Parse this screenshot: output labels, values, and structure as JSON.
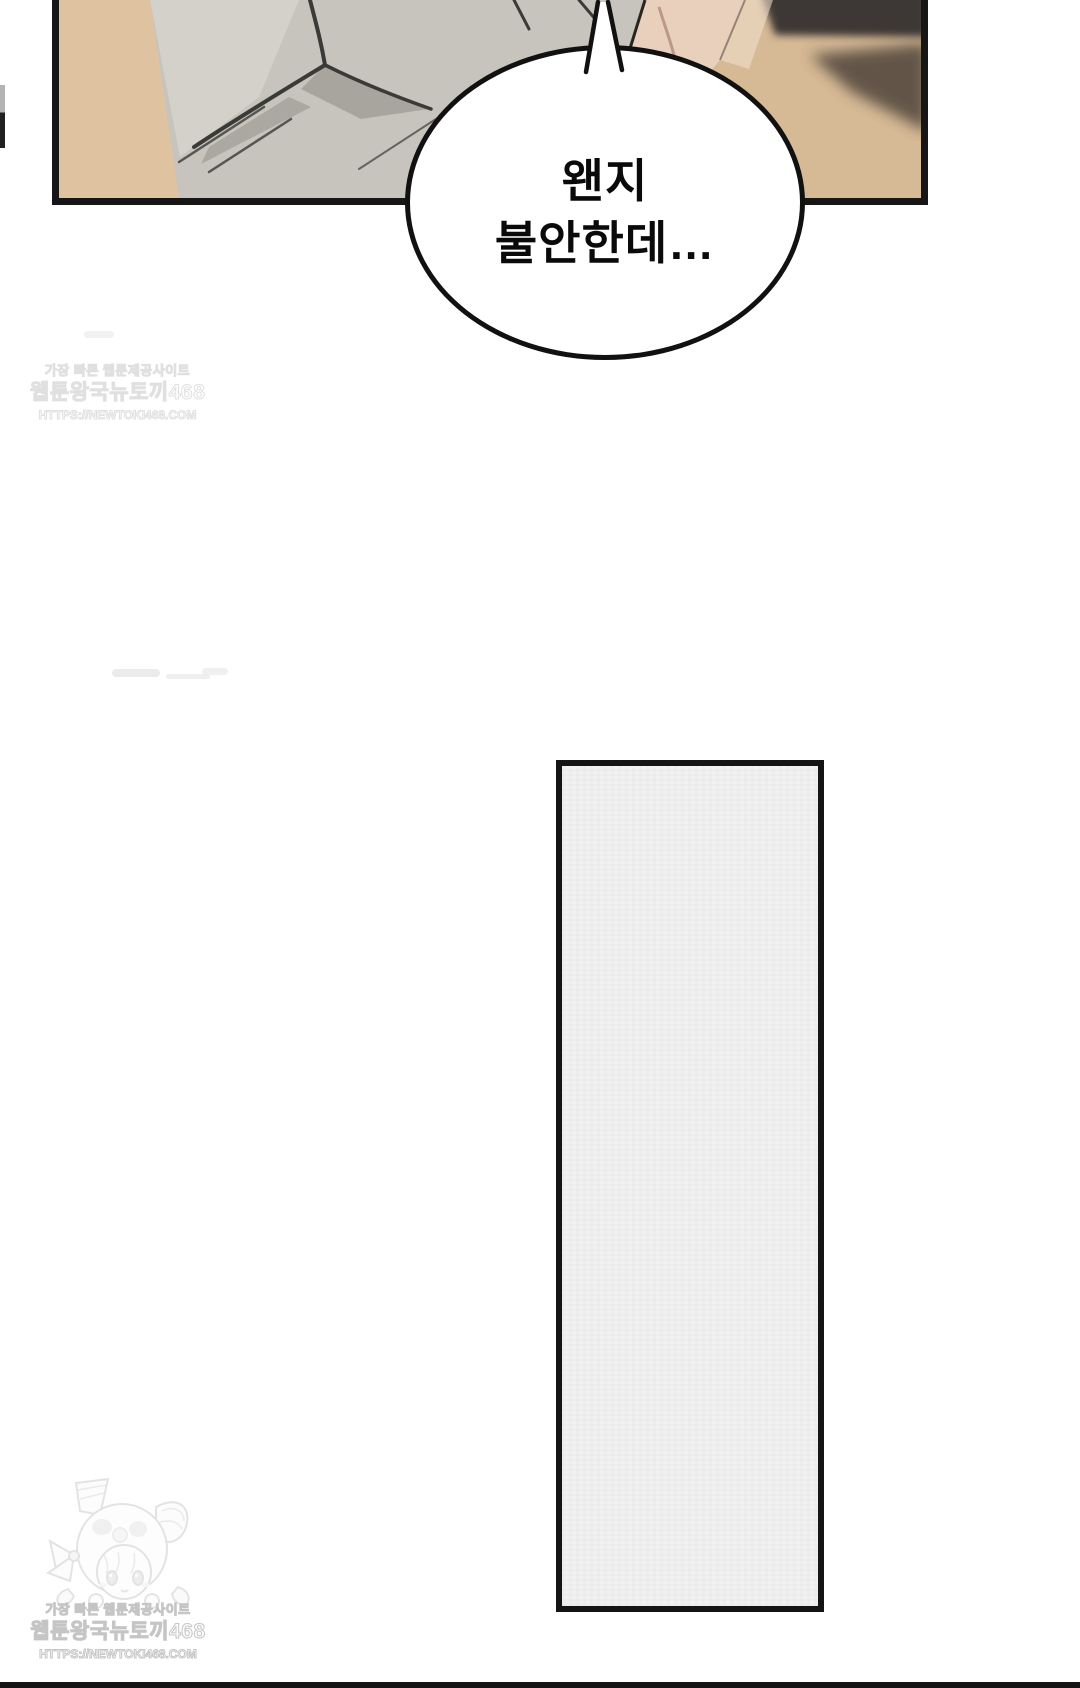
{
  "page": {
    "width": 1080,
    "height": 1688,
    "background": "#ffffff"
  },
  "comic": {
    "speech_bubble": {
      "line1": "왠지",
      "line2": "불안한데…",
      "fill": "#ffffff",
      "stroke": "#111111"
    },
    "top_panel": {
      "border_color": "#161616",
      "wall_color": "#d6b995",
      "wall_light_color": "#dfc3a0",
      "shirt_color": "#c6c4bd",
      "shirt_highlight_color": "#d9d7d0",
      "shirt_shadow_color": "#8e8c84",
      "skin_color": "#e9d0bd",
      "furniture_dark_color": "#3d3935",
      "furniture_mid_color": "#564b41"
    },
    "tall_panel": {
      "fill_color": "#f1f1f2",
      "border_color": "#141414"
    },
    "next_panel_edge_color": "#141414"
  },
  "watermarks": {
    "top": {
      "line1": "가장 빠른 웹툰제공사이트",
      "line2": "웹툰왕국뉴토끼468",
      "line3": "HTTPS://NEWTOKI468.COM"
    },
    "bottom": {
      "line1": "가장 빠른 웹툰제공사이트",
      "line2": "웹툰왕국뉴토끼468",
      "line3": "HTTPS://NEWTOKI468.COM"
    },
    "mascot_icon": "rabbit-hood-chibi-girl-mascot-icon",
    "text_color": "#c4c4c4"
  }
}
